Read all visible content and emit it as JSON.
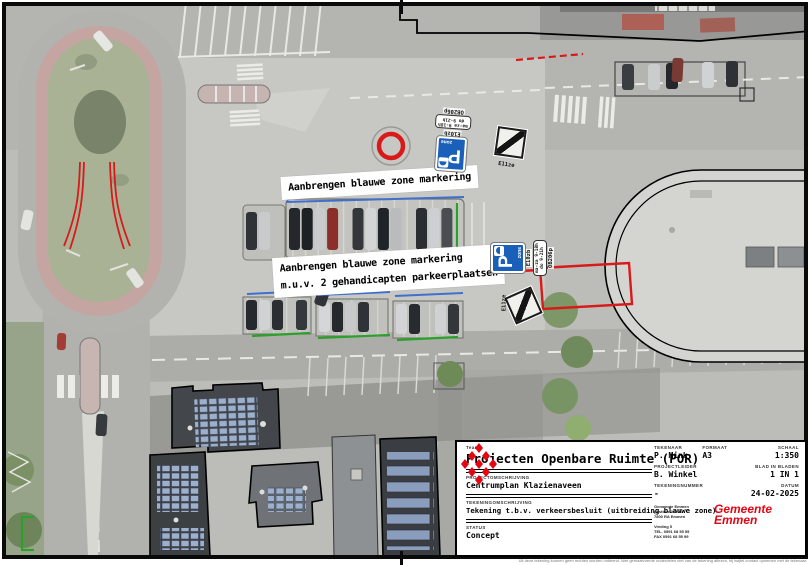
{
  "map": {
    "label1": "Aanbrengen blauwe zone markering",
    "label2_line1": "Aanbrengen blauwe zone markering",
    "label2_line2": "m.u.v. 2 gehandicapten parkeerplaatsen"
  },
  "signs": {
    "e10_code": "E10zb",
    "e11_code": "E11ze",
    "subboard_code": "OB206p",
    "p_letter": "P",
    "zone_text": "zone",
    "times_line1": "ma-za 9-18h",
    "times_line2": "do 9-21h"
  },
  "colors": {
    "annotation_red": "#d81a1a",
    "zone_blue": "#3f6fd0",
    "marking_green": "#2ba12b",
    "sign_blue": "#1a5fb8",
    "logo_red": "#e30613"
  },
  "title_block": {
    "team_label": "Team",
    "team_value": "Projecten Openbare Ruimte (POR)",
    "project_label": "PROJECTOMSCHRIJVING",
    "project_value": "Centrumplan Klazienaveen",
    "drawing_label": "TEKENINGOMSCHRIJVING",
    "drawing_value": "Tekening t.b.v. verkeersbesluit (uitbreiding blauwe zone)",
    "status_label": "STATUS",
    "status_value": "Concept",
    "tekenaar_label": "TEKENAAR",
    "tekenaar_value": "P. Mink",
    "formaat_label": "FORMAAT",
    "formaat_value": "A3",
    "schaal_label": "SCHAAL",
    "schaal_value": "1:350",
    "projectleider_label": "PROJECTLEIDER",
    "projectleider_value": "B. Winkel",
    "blad_label": "BLAD IN BLADEN",
    "blad_value": "1  IN  1",
    "tekeningnummer_label": "TEKENINGNUMMER",
    "tekeningnummer_value": "-",
    "datum_label": "DATUM",
    "datum_value": "24-02-2025",
    "address_line1": "Gemeente Emmen",
    "address_line2": "postbus 30001",
    "address_line3": "7800 RA  Emmen",
    "visit_line1": "Vreding 5",
    "visit_line2": "TEL. 0591 68 55 55",
    "visit_line3": "FAX 0591 68 55 99",
    "logo_line1": "Gemeente",
    "logo_line2": "Emmen",
    "disclaimer": "Uit deze tekening kunnen geen rechten worden ontleend. Niet gemaatvoerde onderdelen niet van de tekening aflezen, bij twijfel contact opnemen met de tekenaar."
  }
}
